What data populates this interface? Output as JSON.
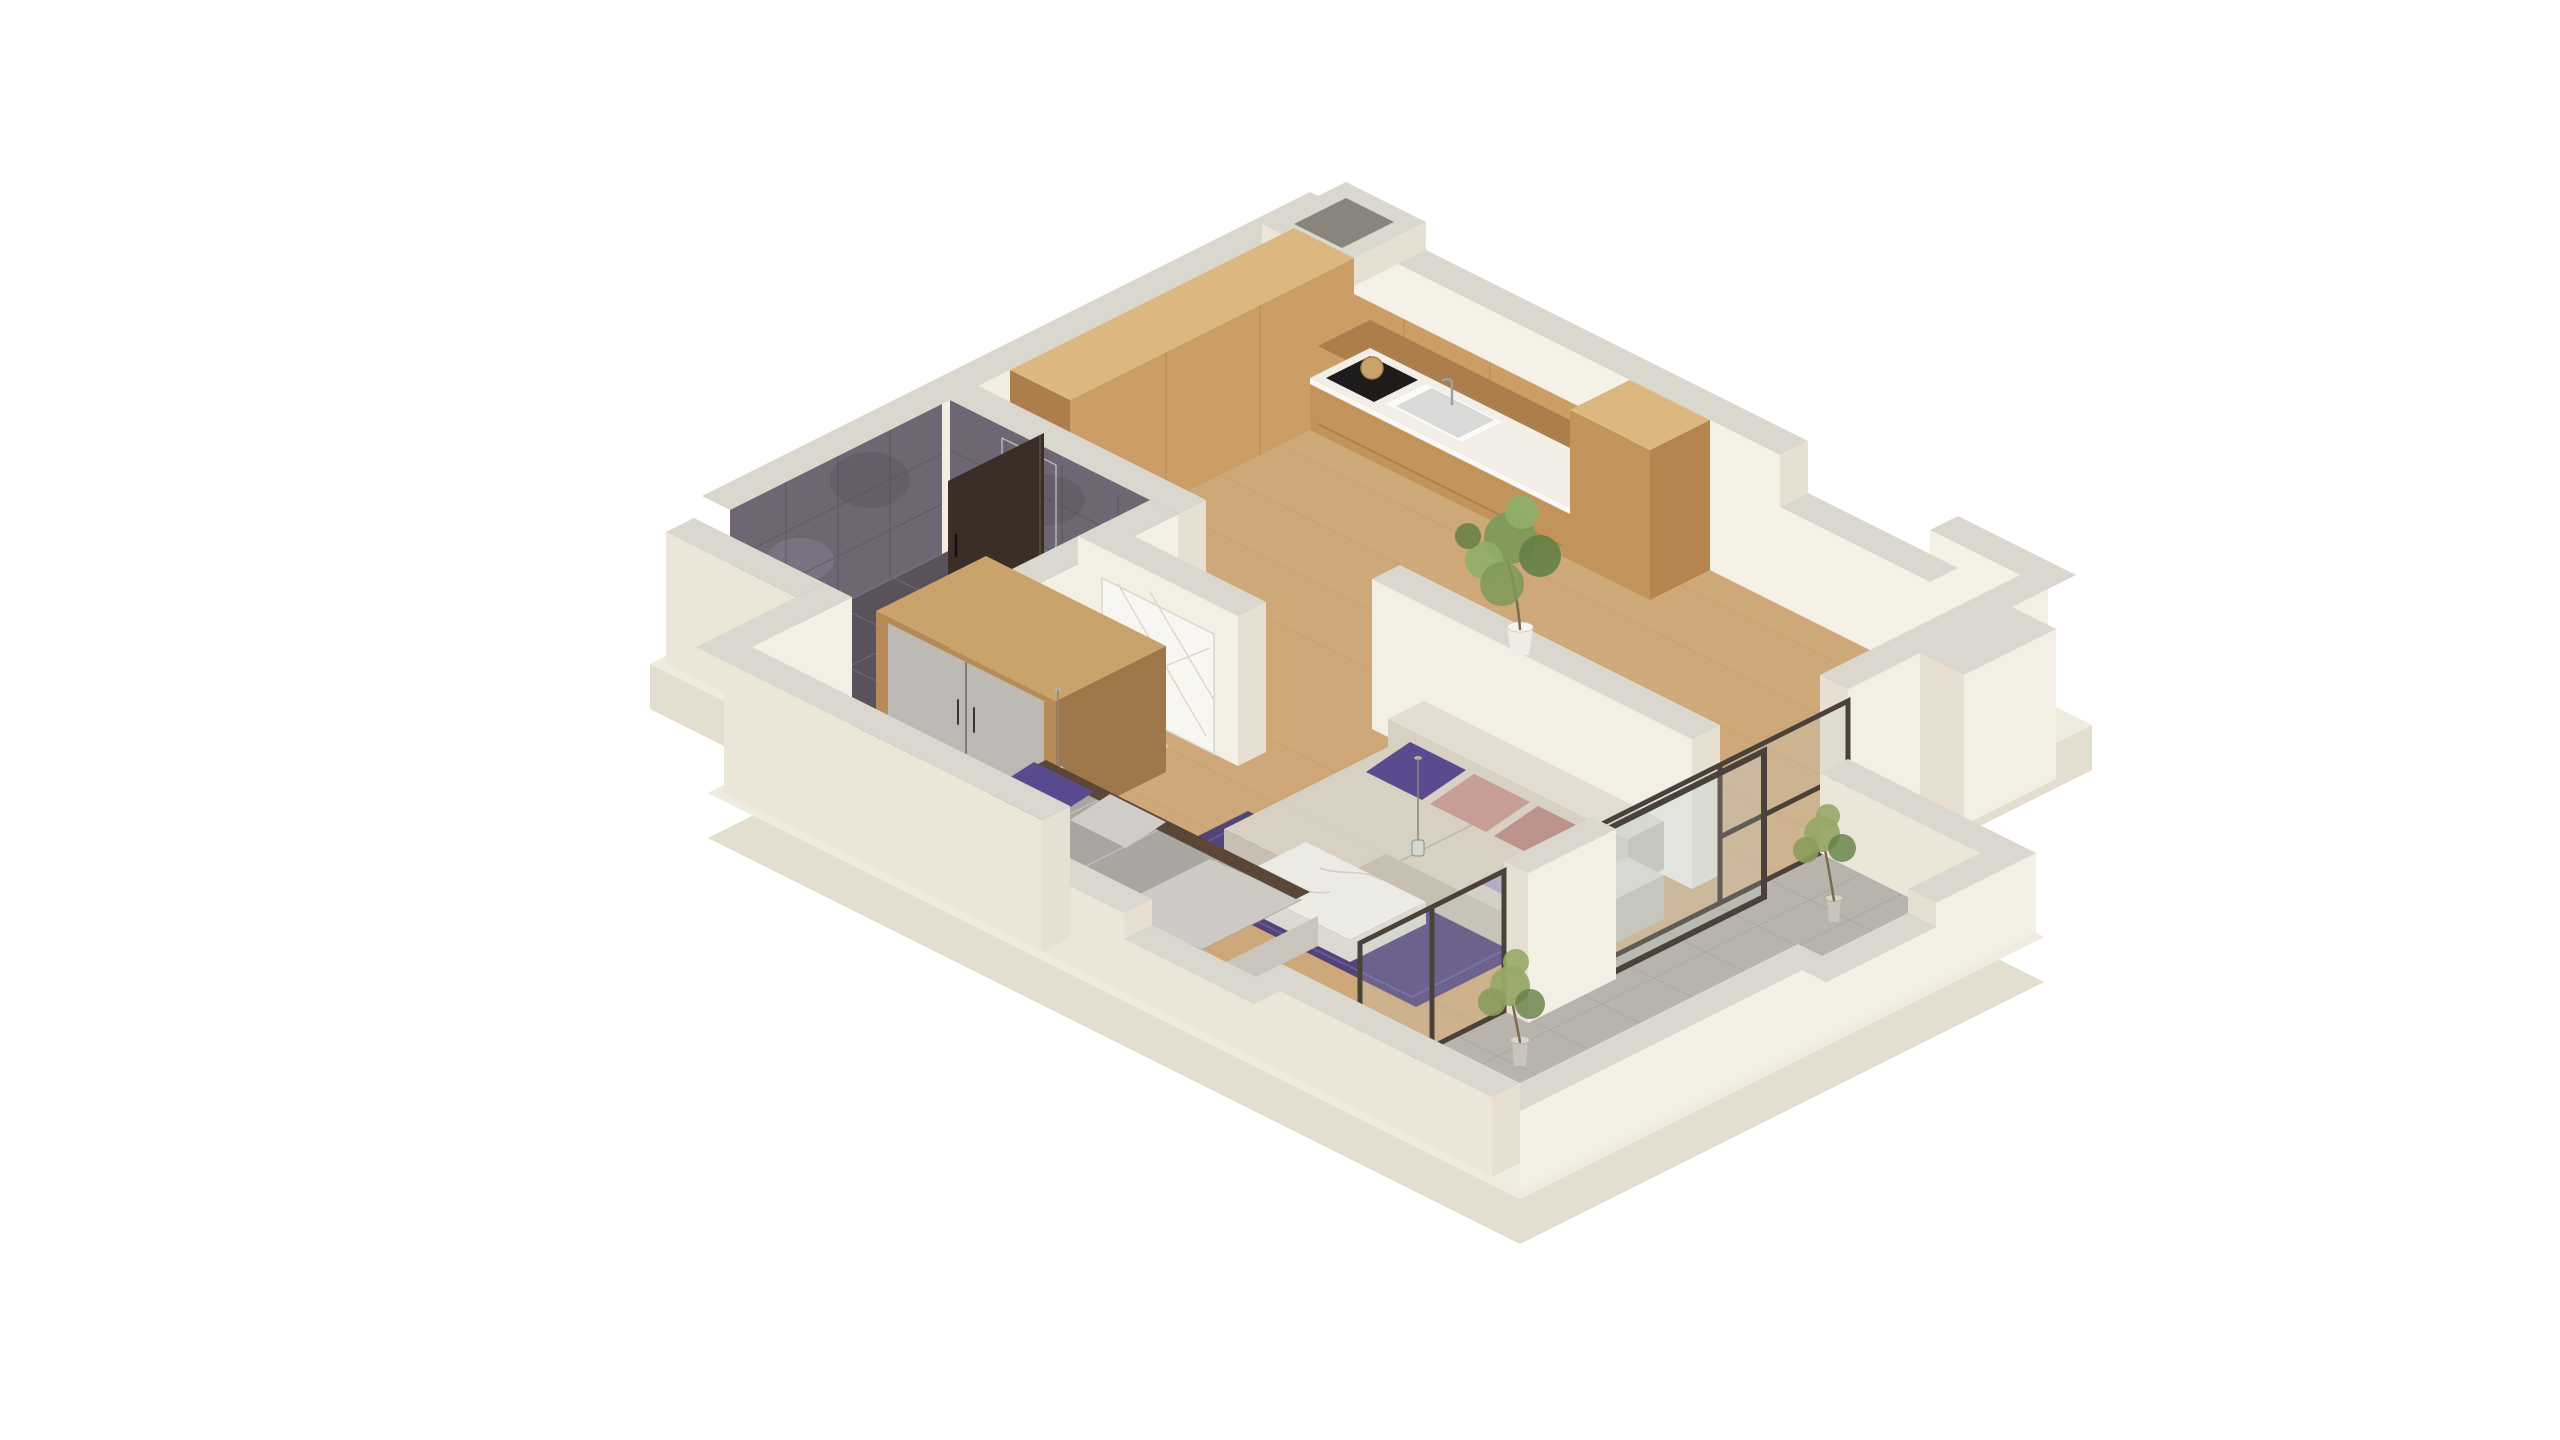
{
  "canvas": {
    "width": 2560,
    "height": 1440,
    "background": "#ffffff"
  },
  "scene": {
    "kind": "isometric-3d-floor-plan-render",
    "projection": "axonometric 2:1 cutaway, white background",
    "rooms": [
      {
        "id": "kitchen",
        "floor": "wood",
        "features": [
          "l-shaped-wood-cabinets",
          "upper-cabinets",
          "white-countertop",
          "sink-with-faucet",
          "dark-cooktop",
          "round-cutting-board",
          "tall-cabinet-column"
        ]
      },
      {
        "id": "bathroom",
        "floor": "dark-tile",
        "features": [
          "dark-slate-tiled-walls",
          "glass-shower-hint",
          "open-dark-walnut-door"
        ]
      },
      {
        "id": "hallway",
        "floor": "wood",
        "features": [
          "white-door-with-diagonal-pattern",
          "potted-plant"
        ]
      },
      {
        "id": "bedroom",
        "floor": "wood",
        "features": [
          "double-bed-gray-blanket",
          "purple-pillows",
          "white-fold-at-foot",
          "dark-wood-rail",
          "wardrobe-wood-frame-gray-doors",
          "pendant-lamps",
          "glass-vase"
        ]
      },
      {
        "id": "living-room",
        "floor": "wood",
        "features": [
          "beige-corner-sofa",
          "purple-and-rose-cushions",
          "purple-rug",
          "marble-coffee-table"
        ]
      },
      {
        "id": "balcony",
        "floor": "gray-tile",
        "features": [
          "bronze-framed-glass-partitions",
          "sliding-door",
          "white-panel",
          "two-potted-plants",
          "notched-parapet-walls"
        ]
      }
    ],
    "structure": [
      "ventilation-shaft-at-apex",
      "notched-top-right-wall",
      "exterior-pilaster",
      "stepped-left-wall",
      "floor-slab"
    ]
  },
  "palette": {
    "bg": "#ffffff",
    "slab_top": "#f0ebdf",
    "slab_side": "#e3ddcf",
    "wood_floor": "#cfa87a",
    "bath_floor": "#57525b",
    "balcony_floor": "#b8b4ad",
    "wall_inner_nw": "#f2ece1",
    "wall_inner_ne": "#f6f1e7",
    "wall_top": "#dad7ce",
    "wall_outer": "#ece6d9",
    "wall_end": "#e7e0d2",
    "wall_face_white": "#f4efe5",
    "tile_wall": "#6e6773",
    "cab_face": "#cb9e66",
    "cab_side": "#ab7e4c",
    "cab_top": "#ddb780",
    "cab_base": "#c2945c",
    "cab_end": "#b4854f",
    "counter": "#f2eee7",
    "cooktop": "#1e1c1a",
    "sink": "#fafaf8",
    "sink_inner": "#d9dad8",
    "board": "#caa26b",
    "wardrobe_wood": "#b78b57",
    "wardrobe_wood_dark": "#9f774a",
    "wardrobe_wood_top": "#caa26b",
    "wardrobe_door": "#bcb9b4",
    "door_white": "#f8f6f1",
    "door_dark": "#3a2e27",
    "glass_frame": "#4a423a",
    "glass_tint": "#c9d3d3",
    "sofa": "#d7d0c3",
    "sofa_dark": "#c7bfb1",
    "sofa_light": "#e2dcd1",
    "pillow_purple": "#5a4a8e",
    "pillow_purple2": "#4e3f80",
    "pillow_rose": "#c79e96",
    "pillow_rose2": "#bd938d",
    "pillow_lilac": "#b0a3c2",
    "rug": "#4a3d78",
    "table_top": "#eceae5",
    "table_side": "#dcd9d2",
    "bed_platform": "#d7d3cc",
    "bed_platform_dark": "#c9c4bc",
    "bed_blanket": "#a9a5a1",
    "bed_band": "#9b9793",
    "bed_fold": "#d0ccc7",
    "bed_rail": "#5b4737",
    "plant_green": "#7d9a58",
    "plant_green2": "#8fae68",
    "plant_green_dark": "#647f45",
    "balcony_plant": "#97a968",
    "balcony_plant2": "#8a9c5d",
    "pot_white": "#efece4",
    "pot_gray": "#c9c5bc",
    "shaft_hole": "#8a857c"
  }
}
